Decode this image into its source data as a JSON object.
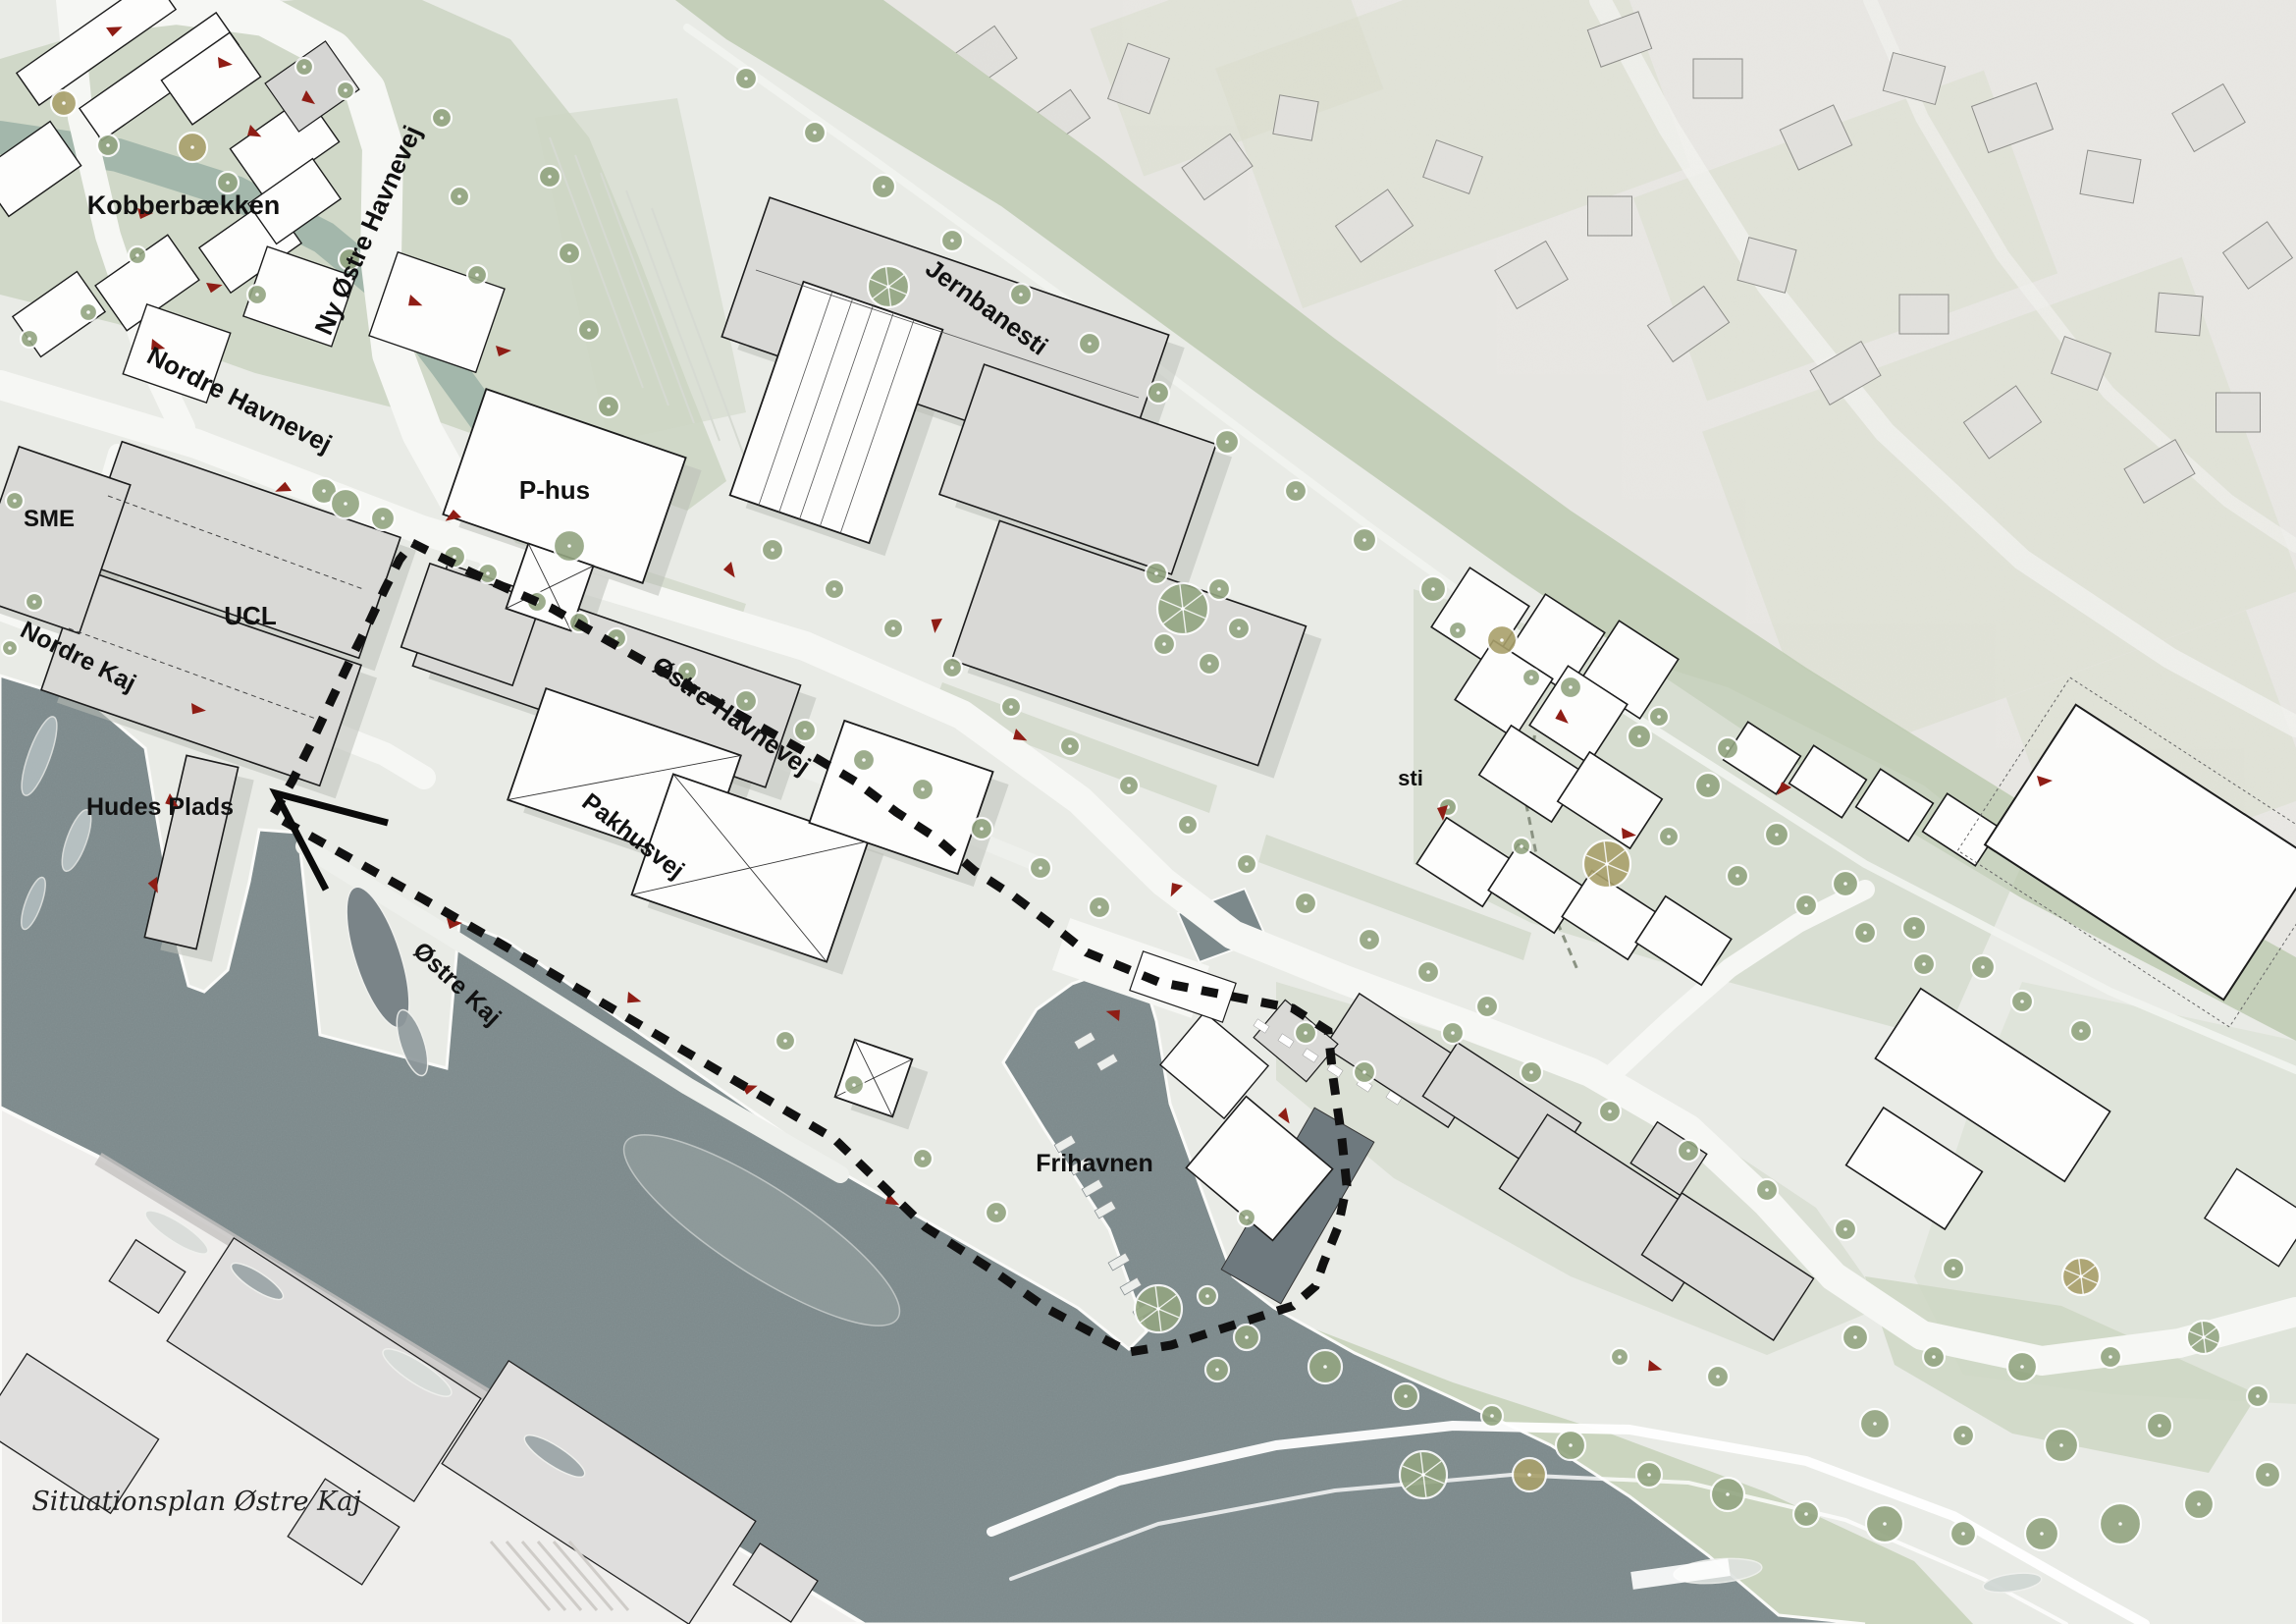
{
  "title": "Situationsplan Østre Kaj",
  "labels": {
    "kobberbaekken": "Kobberbækken",
    "ny_oestre_havnevej": "Ny Østre Havnevej",
    "jernbanesti": "Jernbanesti",
    "nordre_havnevej": "Nordre Havnevej",
    "sme": "SME",
    "ucl": "UCL",
    "p_hus": "P-hus",
    "nordre_kaj": "Nordre Kaj",
    "hudes_plads": "Hudes Plads",
    "oestre_havnevej": "Østre Havnevej",
    "pakhusvej": "Pakhusvej",
    "oestre_kaj": "Østre Kaj",
    "frihavnen": "Frihavnen",
    "sti": "sti",
    "caption": "Situationsplan Østre Kaj"
  },
  "elements": {
    "boundary_dashed_line": "project area boundary",
    "view_angle_mark": "V-shaped annotation at Hudes Plads",
    "entrance_marker": "red triangle marker",
    "tree_icon": "tree canopy circle",
    "boat_icon": "moored vessel"
  },
  "colors": {
    "water": "#7c898b",
    "land": "#e9ebe6",
    "aerial_land": "#e7e6e2",
    "park_green": "#cdd6c4",
    "rail_green": "#bdcab0",
    "stream_green": "#9db4a7",
    "building_gray": "#d9d9d6",
    "building_white": "#fdfdfc",
    "outline": "#1c1c1c",
    "tree_green": "#93a581",
    "tree_olive": "#a9a06b",
    "road_white": "#f6f7f4",
    "marker_red": "#8f1d15",
    "boundary_black": "#111111",
    "dark_ship": "#6e797e",
    "shadow": "#bcbfb8"
  }
}
